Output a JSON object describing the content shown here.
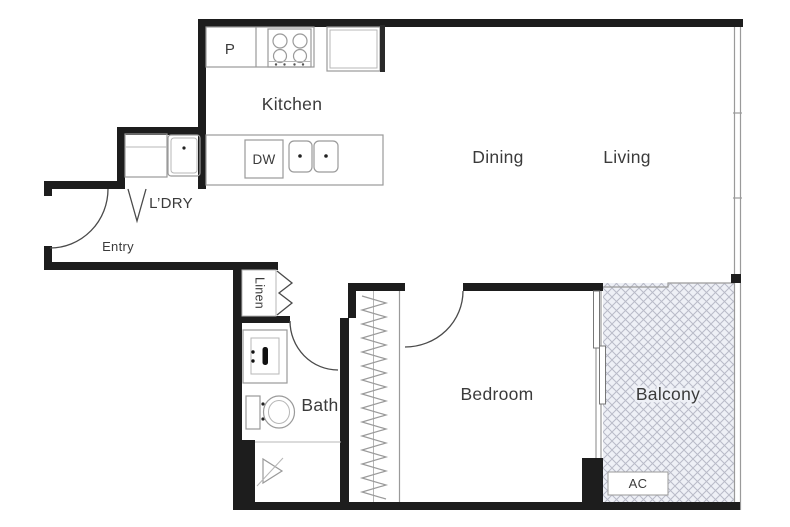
{
  "plan_title": "One-bedroom apartment floor plan",
  "rooms": {
    "kitchen": "Kitchen",
    "dining": "Dining",
    "living": "Living",
    "bedroom": "Bedroom",
    "bath": "Bath",
    "balcony": "Balcony"
  },
  "labels": {
    "entry": "Entry",
    "laundry": "L’DRY",
    "linen": "Linen"
  },
  "appliances": {
    "pantry": "P",
    "dishwasher": "DW",
    "air_conditioner": "AC"
  },
  "colors": {
    "wall": "#1d1d1d",
    "fixture_line": "#9a9a9a",
    "door_line": "#4a4a4a",
    "text": "#3b3b3b",
    "balcony_fill": "#eef0f6",
    "balcony_hatch": "#b9bbc8",
    "background": "#ffffff"
  }
}
